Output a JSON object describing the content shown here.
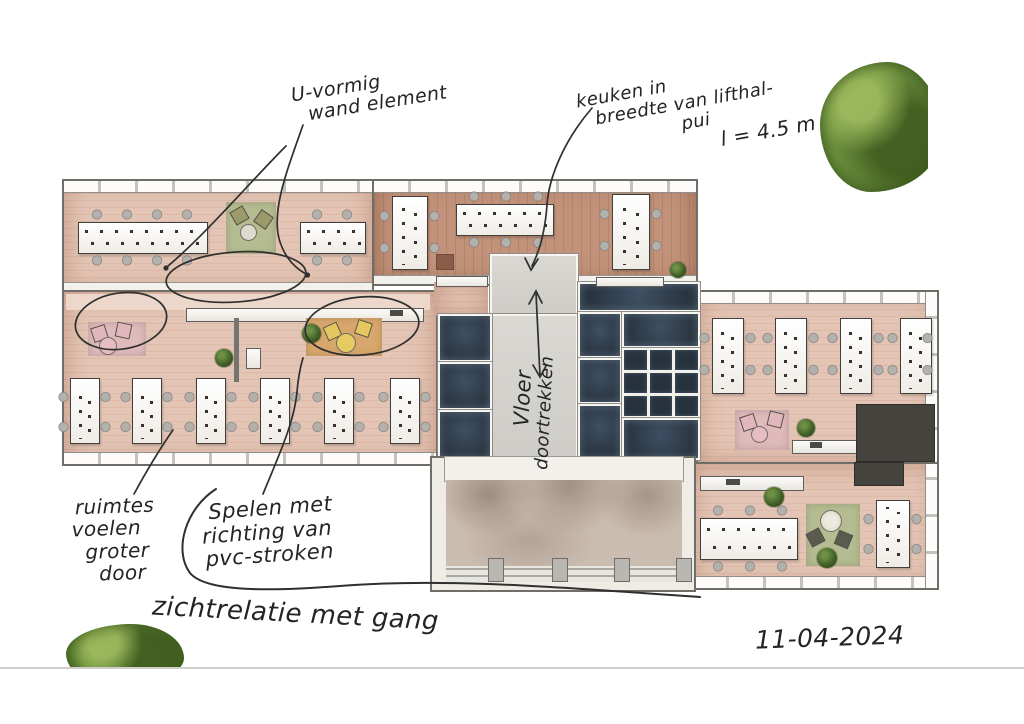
{
  "sketch": {
    "date": "11-04-2024",
    "annotations": {
      "u_vormig": [
        "U-vormig",
        "wand element"
      ],
      "keuken": [
        "keuken in",
        "breedte van lifthal-",
        "pui",
        "l = 4.5 m"
      ],
      "vloer": [
        "Vloer",
        "doortrekken"
      ],
      "ruimtes": [
        "ruimtes",
        "voelen",
        "groter",
        "door"
      ],
      "spelen": [
        "Spelen met",
        "richting van",
        "pvc-stroken"
      ],
      "zichtrelatie": "zichtrelatie met gang"
    },
    "colors": {
      "ink": "#2f2f2f",
      "floor_pink": "#e4c5b5",
      "floor_wood_dark": "#c2927a",
      "core_room_dark": "#2c3845",
      "corridor_gray": "#d5d3ce",
      "rug_green": "#b5bc91",
      "rug_pink": "#debabd",
      "rug_tan": "#d8a76d",
      "tree_green": "#6e9140"
    }
  }
}
